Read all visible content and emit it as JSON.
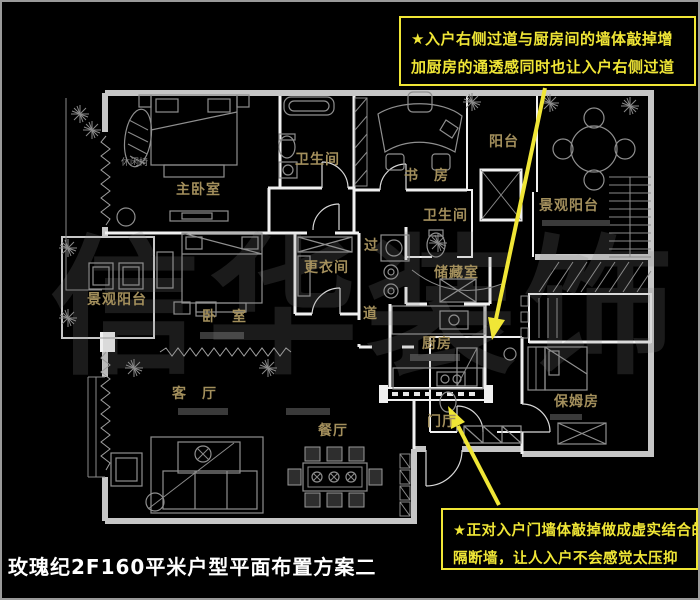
{
  "title": "玫瑰纪2F160平米户型平面布置方案二",
  "watermark": "信华装饰",
  "colors": {
    "accent_yellow": "#f0e636",
    "label_gold": "#a38f5c",
    "wall_gray": "#c6c6c6",
    "wall_white": "#f0f0f0",
    "furniture_gray": "#8f8f8f",
    "furniture_dark": "#3a3a3a",
    "watermark_gray": "#888888",
    "title_white": "#ffffff"
  },
  "annotations": {
    "top_note": {
      "lines": [
        "★入户右侧过道与厨房间的墙体敲掉增",
        "加厨房的通透感同时也让入户右侧过道"
      ]
    },
    "bottom_note": {
      "lines": [
        "★正对入户门墙体敲掉做成虚实结合的",
        "隔断墙，让人入户不会感觉太压抑"
      ]
    }
  },
  "rooms": {
    "master_bedroom": "主卧室",
    "master_bath": "卫生间",
    "study": "书　房",
    "balcony": "阳台",
    "view_balcony_right": "景观阳台",
    "hall_bath": "卫生间",
    "corridor_top": "过",
    "corridor_bottom": "道",
    "dressing_room": "更衣间",
    "storage_room": "储藏室",
    "kitchen": "厨房",
    "view_balcony_left": "景观阳台",
    "bedroom": "卧　室",
    "living_room": "客　厅",
    "dining_room": "餐厅",
    "foyer": "门厅",
    "nanny_room": "保姆房"
  },
  "furniture_labels": {
    "lounge_chair": "休闲椅"
  }
}
